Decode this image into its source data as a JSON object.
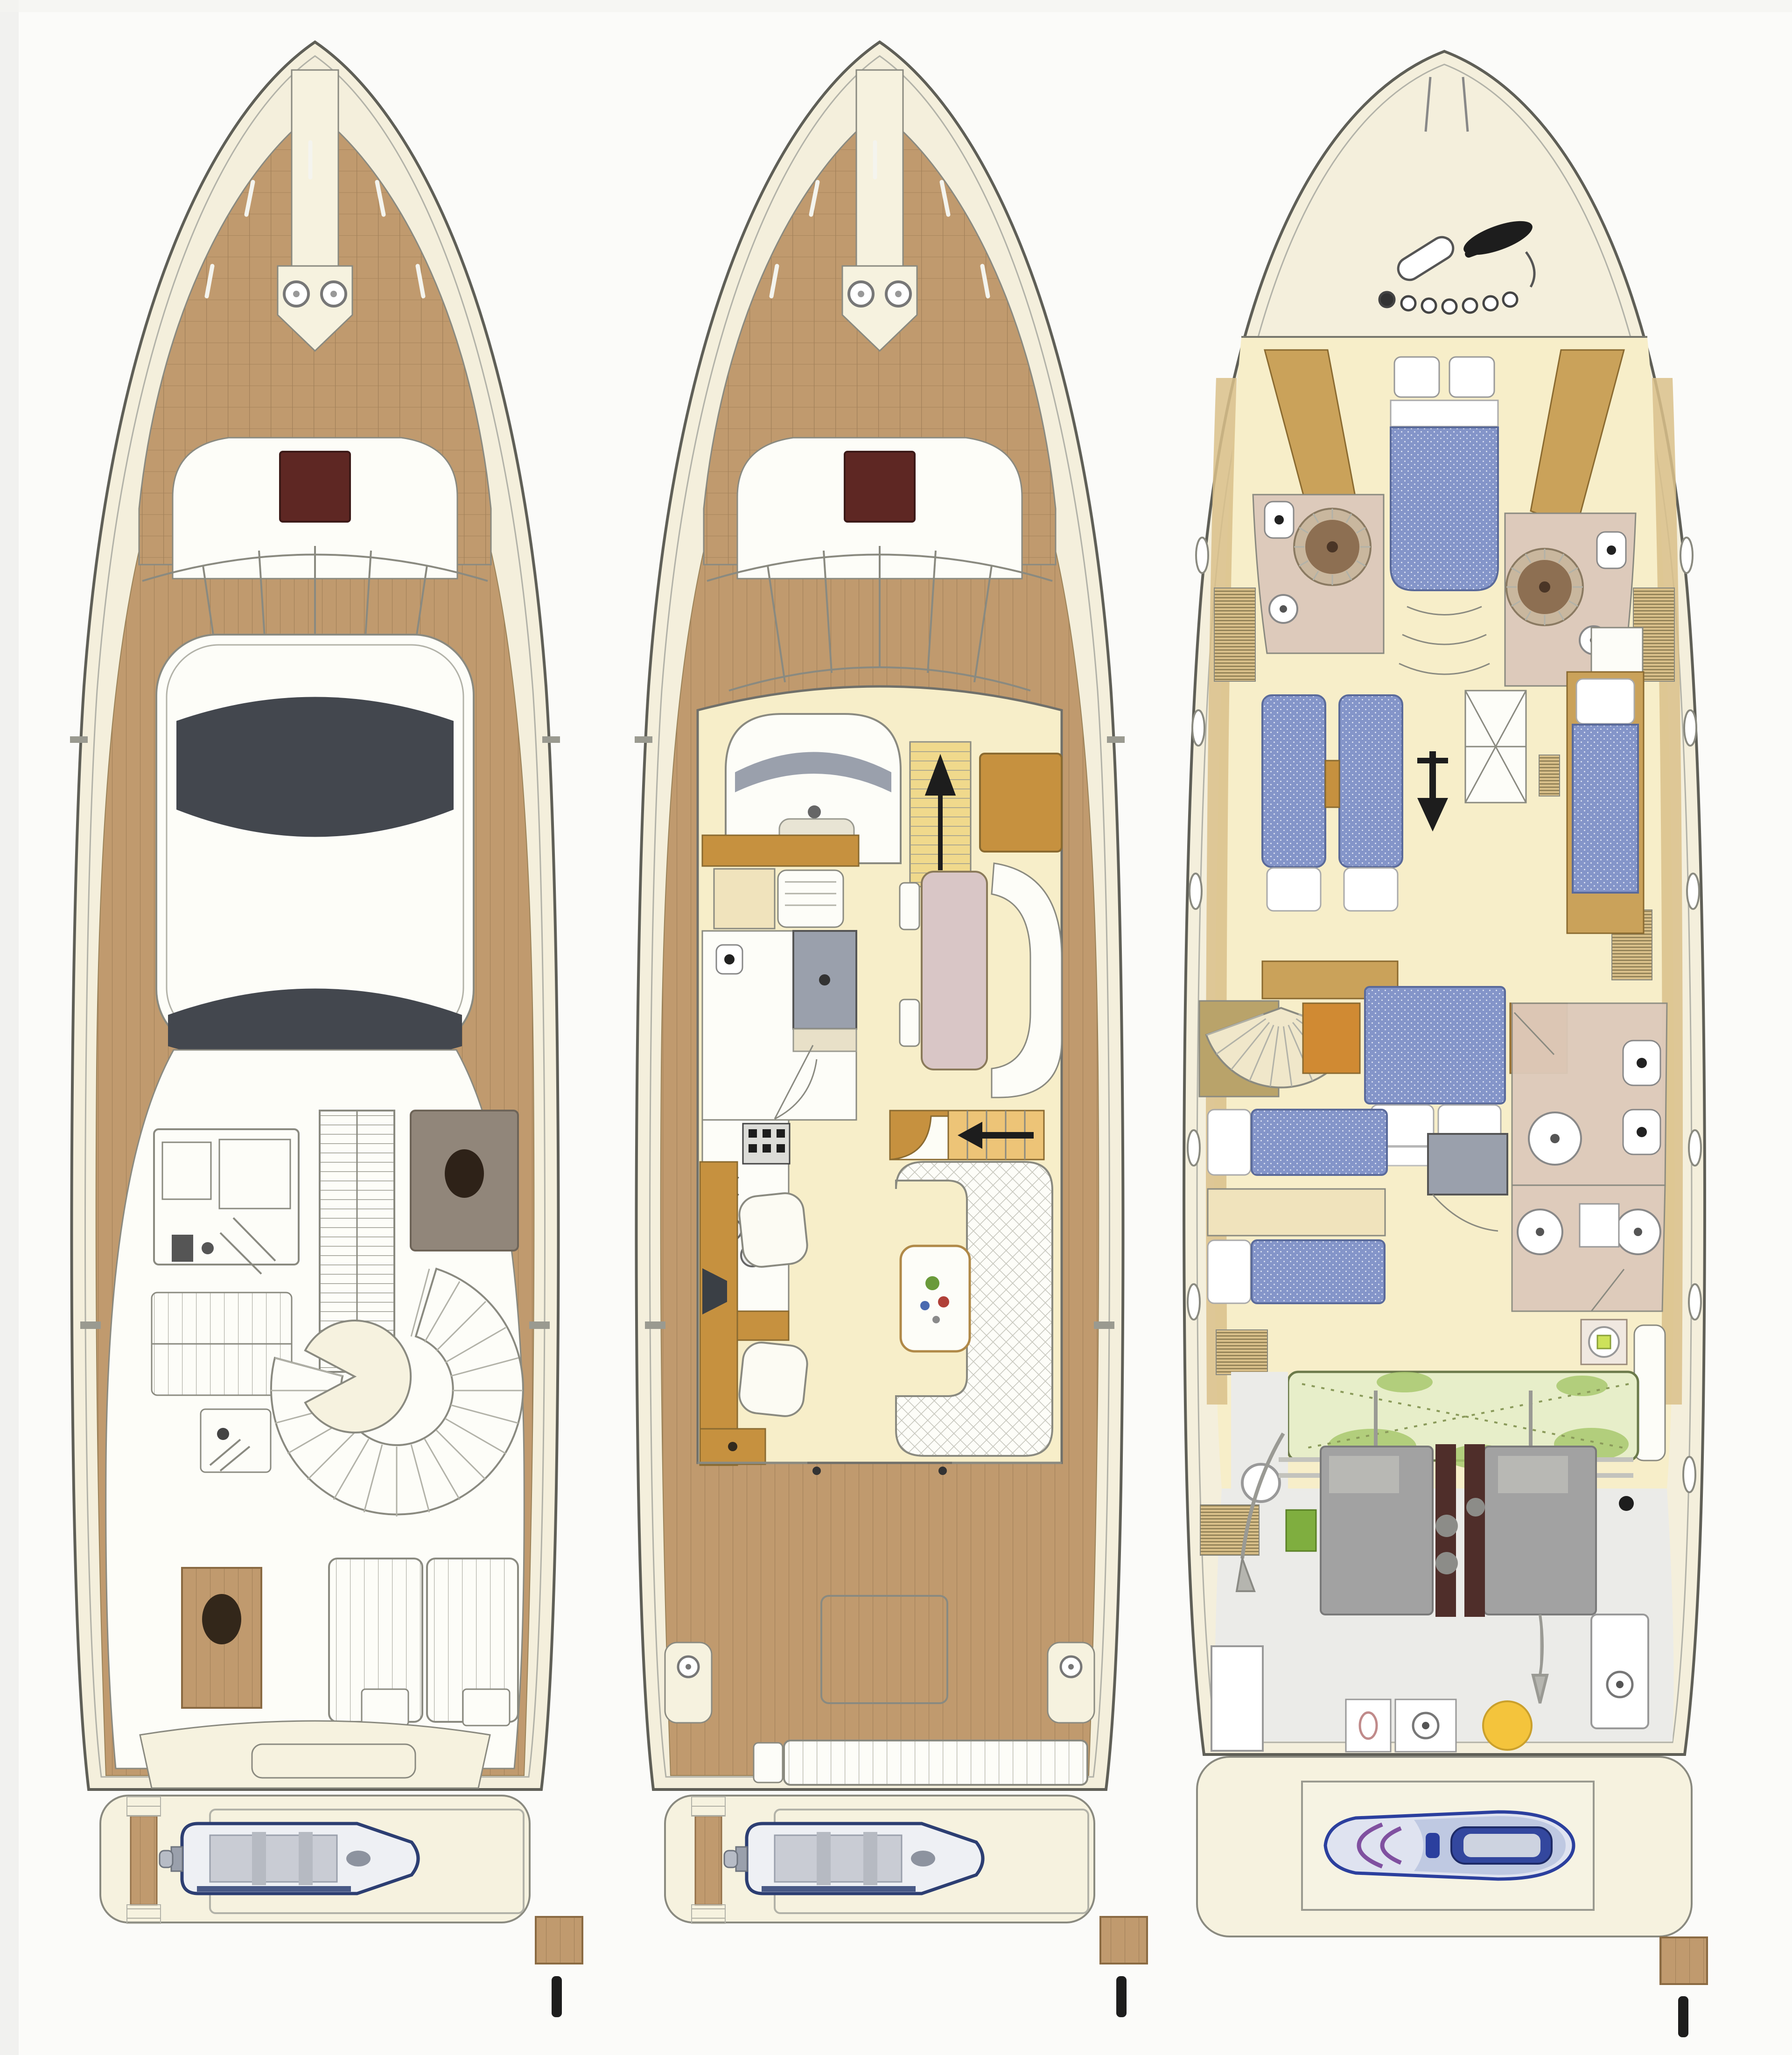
{
  "figure": {
    "kind": "yacht-deck-plan-diagram",
    "panels": [
      {
        "id": "flybridge-deck-plan",
        "features": [
          "teak-foredeck",
          "anchor-windlass",
          "bow-sun-pad",
          "deck-hatch",
          "windshield",
          "hardtop",
          "open-sunroof",
          "flybridge-windscreen",
          "helm-console",
          "copilot-seat-pad",
          "companionway-ladder",
          "bench-seat",
          "wet-bar",
          "curved-settee",
          "round-table",
          "side-table",
          "aft-sun-pads",
          "transom-molding",
          "swim-platform",
          "tender-dinghy",
          "outboard-motor",
          "passerelle",
          "stern-bollard"
        ]
      },
      {
        "id": "main-deck-plan",
        "features": [
          "teak-foredeck",
          "anchor-windlass",
          "bow-sun-pad",
          "deck-hatch",
          "windshield",
          "helm-station",
          "companionway-stairs-up",
          "sideboard",
          "pullman-settee",
          "dinette-table",
          "dinette-bench",
          "day-head-shower",
          "day-head-toilet",
          "galley-sink",
          "galley-stove",
          "companionway-stairs-down",
          "tv-cabinet",
          "armchairs",
          "u-shaped-sofa",
          "coffee-table-flowers",
          "salon-aft-door",
          "side-deck-gates",
          "aft-deck-hatch",
          "mooring-winches",
          "stern-bench",
          "swim-platform",
          "tender-dinghy",
          "outboard-motor",
          "passerelle",
          "stern-bollard"
        ]
      },
      {
        "id": "lower-deck-plan",
        "features": [
          "bow-rails",
          "anchor-and-chain",
          "vip-cabin-double-bed",
          "vip-wardrobes",
          "port-head-shower",
          "starboard-head-shower",
          "toilets",
          "sinks",
          "guest-cabin-twin-beds",
          "guest-cabin-single-bed",
          "companionway-landing",
          "corridor-arrow",
          "portholes",
          "side-lockers",
          "spiral-staircase",
          "master-cabin-double-bed",
          "master-wardrobes",
          "crew-berths",
          "shower-stall",
          "bathrooms-aft",
          "washing-machine",
          "utility-fixtures",
          "fuel-tank-compartment",
          "engine-room",
          "twin-engines",
          "exhausts",
          "propeller-shafts",
          "generator",
          "muffler-yellow",
          "garage",
          "jet-ski",
          "swim-platform",
          "passerelle",
          "stern-bollard"
        ]
      }
    ]
  },
  "colors": {
    "paper": "#fbfbf9",
    "edgeShade": "#ededeb",
    "hullStroke": "#5f5f57",
    "hullFill": "#f4efdc",
    "lineGray": "#8a8a80",
    "lightLine": "#b2b2a8",
    "teak": "#c09a6e",
    "teakLine": "#a3815a",
    "teakLine2": "#ad8960",
    "ivory": "#f6f2df",
    "white": "#fdfdf8",
    "paleYellow": "#f7eec9",
    "paleYellow2": "#f3e8bd",
    "sunroofDark": "#43474e",
    "hatchRed": "#5e2723",
    "glassGray": "#9aa0ac",
    "mattressBlue": "#8495c9",
    "mattressEdge": "#5a6a9a",
    "pillow": "#ffffff",
    "woodBrown": "#c6913f",
    "woodTan": "#caa25a",
    "woodOrange": "#d08a33",
    "woodEdge": "#8a6a30",
    "stepYellow": "#f0d98c",
    "bathPink": "#ddcabb",
    "showerBrown": "#8d6f52",
    "showerRing": "#c9b79e",
    "showerDark": "#4a3526",
    "fixtureGray": "#b4bac4",
    "engineGray": "#a2a2a2",
    "engineDark": "#7a7a7a",
    "exhaust": "#4f2e2a",
    "tankGreen": "#e7eec9",
    "leafGreen": "#a8c86e",
    "tankStroke": "#6b7a4a",
    "jetskiNavy": "#2b3f9e",
    "jetskiBody": "#dfe3f0",
    "jetskiPurple": "#8050a0",
    "accentYellow": "#f4c43c",
    "tenderNavy": "#2c3e72",
    "tenderGray": "#c9ccd4",
    "lawnGreen": "#7fae3f",
    "washerGreen": "#cde25a",
    "black": "#1d1d1d",
    "khaki": "#d9c08a",
    "landingKhaki": "#b9a36a",
    "creamCab": "#f0e3bc",
    "dinettePink": "#d9c6c6",
    "chairWhite": "#fcfbf3"
  }
}
